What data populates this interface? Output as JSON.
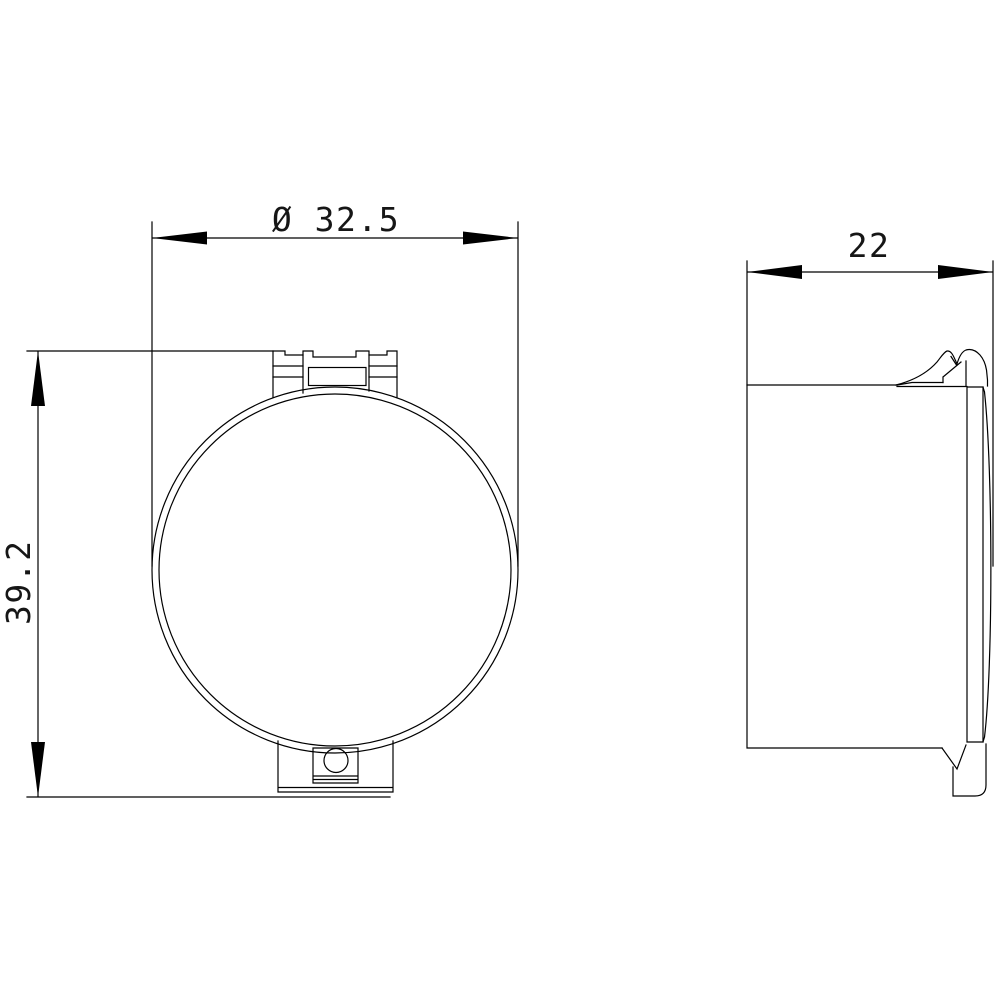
{
  "drawing": {
    "kind": "technical-dimension-drawing",
    "background": "#ffffff",
    "line_color": "#000000",
    "dimensions": {
      "diameter": {
        "label": "Ø 32.5",
        "value": 32.5
      },
      "height": {
        "label": "39.2",
        "value": 39.2
      },
      "depth": {
        "label": "22",
        "value": 22
      }
    }
  }
}
